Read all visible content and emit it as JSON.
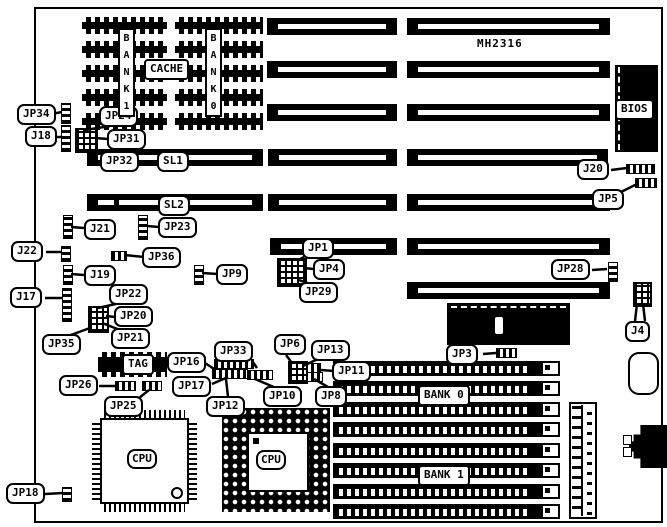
{
  "diagram": {
    "part_number": "MH2316",
    "callouts": {
      "jp34": "JP34",
      "j18": "J18",
      "jp24": "JP24",
      "jp31": "JP31",
      "jp32": "JP32",
      "sl1": "SL1",
      "sl2": "SL2",
      "j21": "J21",
      "jp23": "JP23",
      "j22": "J22",
      "jp36": "JP36",
      "j19": "J19",
      "jp9": "JP9",
      "j17": "J17",
      "jp22": "JP22",
      "jp20": "JP20",
      "jp21": "JP21",
      "jp35": "JP35",
      "jp16": "JP16",
      "jp26": "JP26",
      "jp17": "JP17",
      "jp25": "JP25",
      "jp33": "JP33",
      "jp12": "JP12",
      "jp10": "JP10",
      "jp6": "JP6",
      "jp13": "JP13",
      "jp11": "JP11",
      "jp8": "JP8",
      "jp18": "JP18",
      "jp1": "JP1",
      "jp4": "JP4",
      "jp29": "JP29",
      "jp3": "JP3",
      "j20": "J20",
      "jp5": "JP5",
      "jp28": "JP28",
      "j4": "J4"
    },
    "chips": {
      "cache": "CACHE",
      "cache_bank_left": "BANK 1",
      "cache_bank_right": "BANK 0",
      "bios": "BIOS",
      "keyboard_controller": "KBD",
      "tag": "TAG",
      "cpu_qfp": "CPU",
      "cpu_pga": "CPU",
      "simm_bank_top": "BANK 0",
      "simm_bank_bottom": "BANK 1"
    }
  }
}
